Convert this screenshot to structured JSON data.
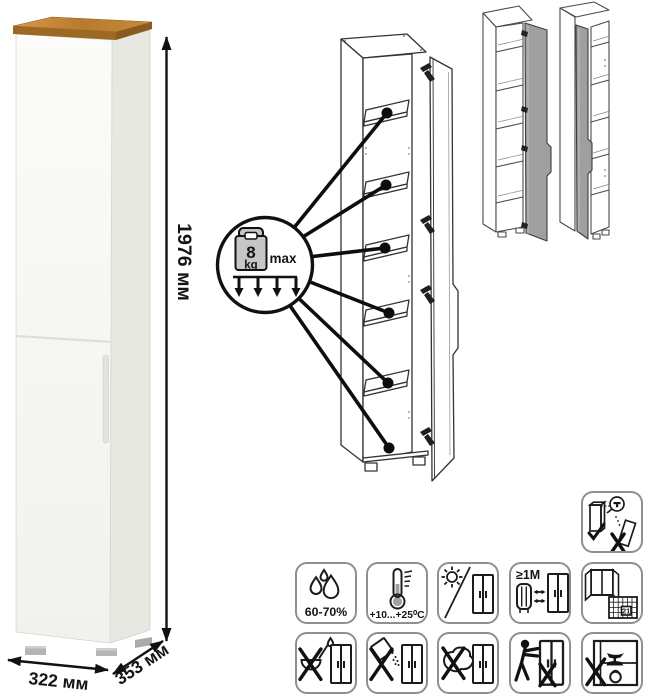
{
  "dimensions": {
    "height": "1976 мм",
    "width": "322 мм",
    "depth": "353 мм"
  },
  "shelf_load": {
    "value": "8",
    "unit": "kg",
    "max_label": "max"
  },
  "care_labels": {
    "humidity": "60-70%",
    "temperature": "+10...+25⁰C",
    "min_heat_distance": "≥1M",
    "calendar_day": "21"
  },
  "care_icons": {
    "row1": [
      "humidity-60-70",
      "temperature-range",
      "no-direct-sunlight",
      "keep-1m-from-heat-source",
      "ventilate-room-calendar"
    ],
    "row2": [
      "no-liquid-pouring",
      "no-abrasive-powder",
      "no-wet-sponge",
      "no-pushing-dragging",
      "no-heavy-load"
    ],
    "standalone": "anchor-to-wall"
  },
  "colors": {
    "wood_top": "#b87a2c",
    "cabinet_front": "#f6f6f3",
    "cabinet_side": "#e8e8e3",
    "variant_door_gray": "#9f9f9f",
    "line_art": "#333333",
    "callout": "#0d0d0d"
  }
}
